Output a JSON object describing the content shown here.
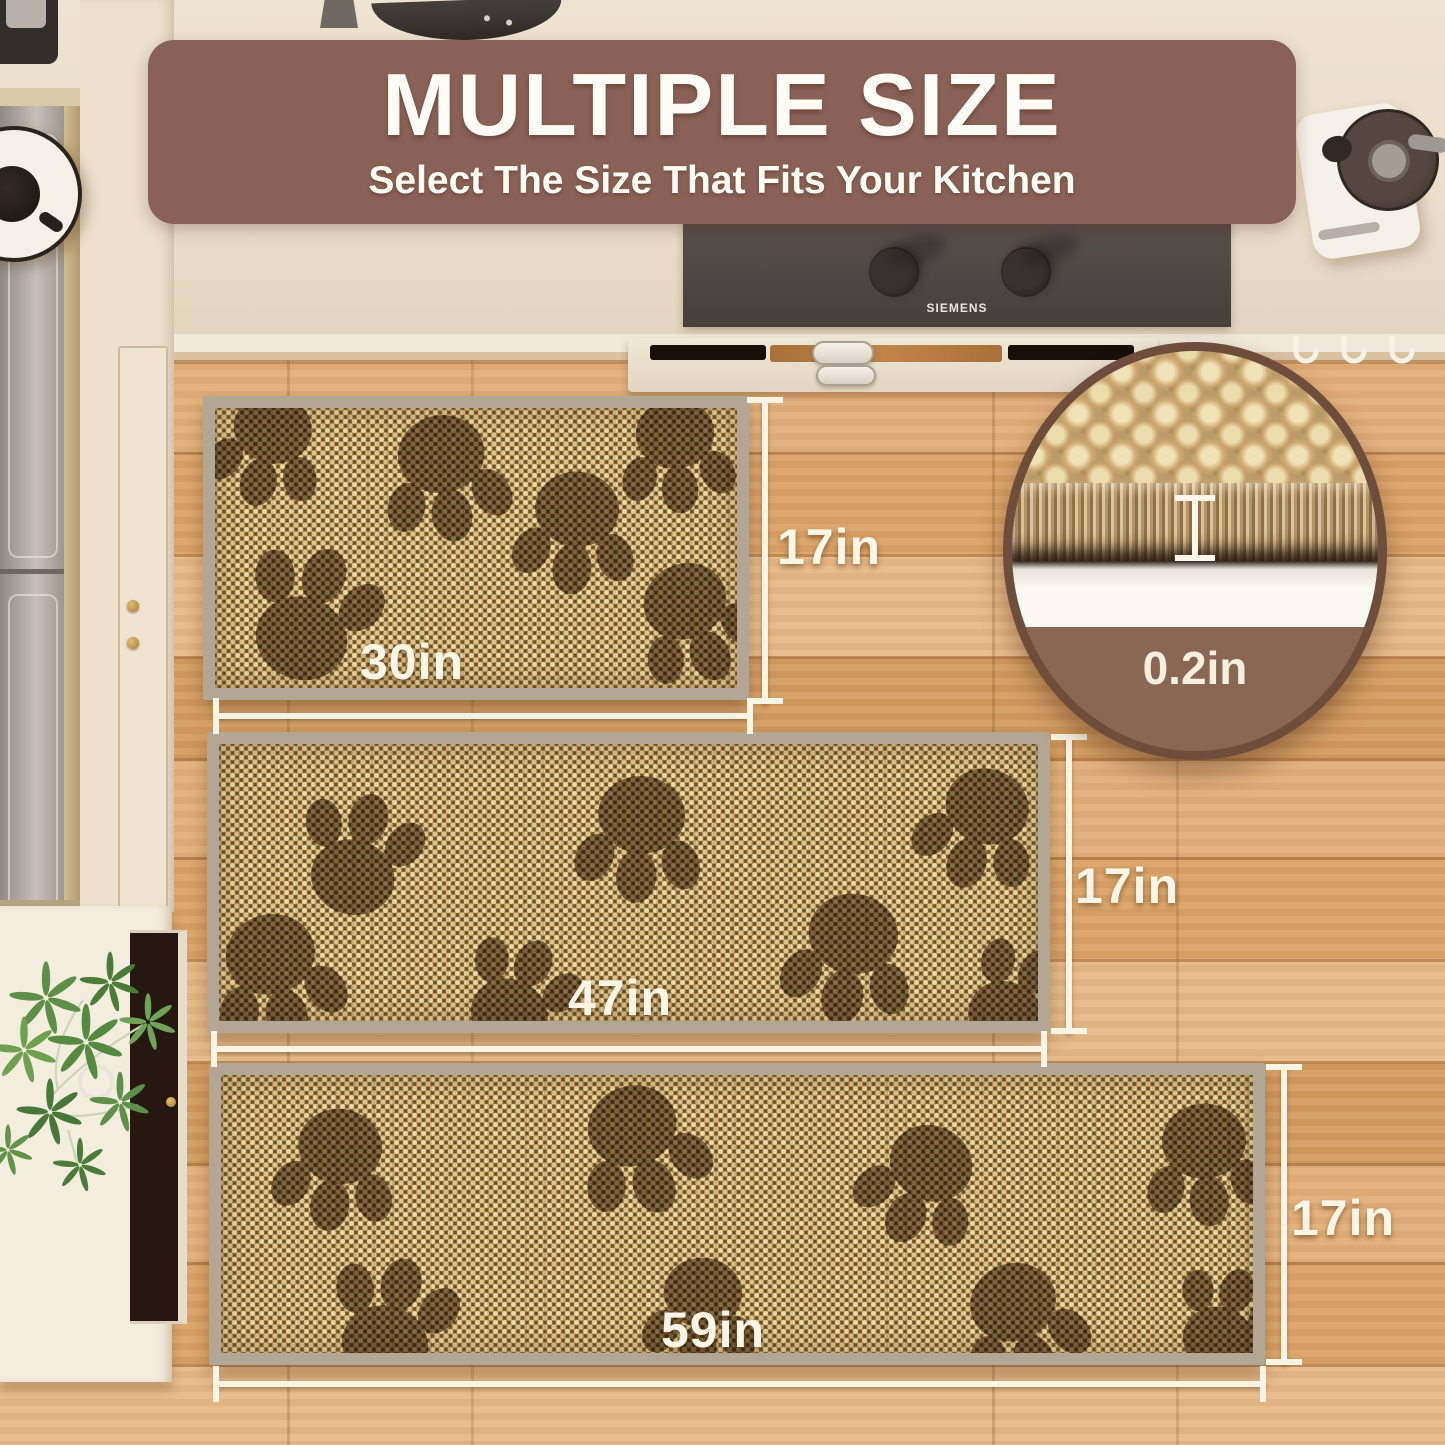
{
  "banner": {
    "title": "MULTIPLE SIZE",
    "subtitle": "Select The Size That Fits Your Kitchen"
  },
  "cooktop": {
    "brand": "SIEMENS"
  },
  "inset": {
    "thickness_label": "0.2in"
  },
  "mats": [
    {
      "size_id": "30in-x-17in",
      "width_label": "30in",
      "height_label": "17in"
    },
    {
      "size_id": "47in-x-17in",
      "width_label": "47in",
      "height_label": "17in"
    },
    {
      "size_id": "59in-x-17in",
      "width_label": "59in",
      "height_label": "17in"
    }
  ],
  "colors": {
    "banner_bg": "#8a6156",
    "dimension_text": "#faf4e4",
    "mat_border": "#b2a794",
    "inset_rim": "#6e4e3b"
  }
}
